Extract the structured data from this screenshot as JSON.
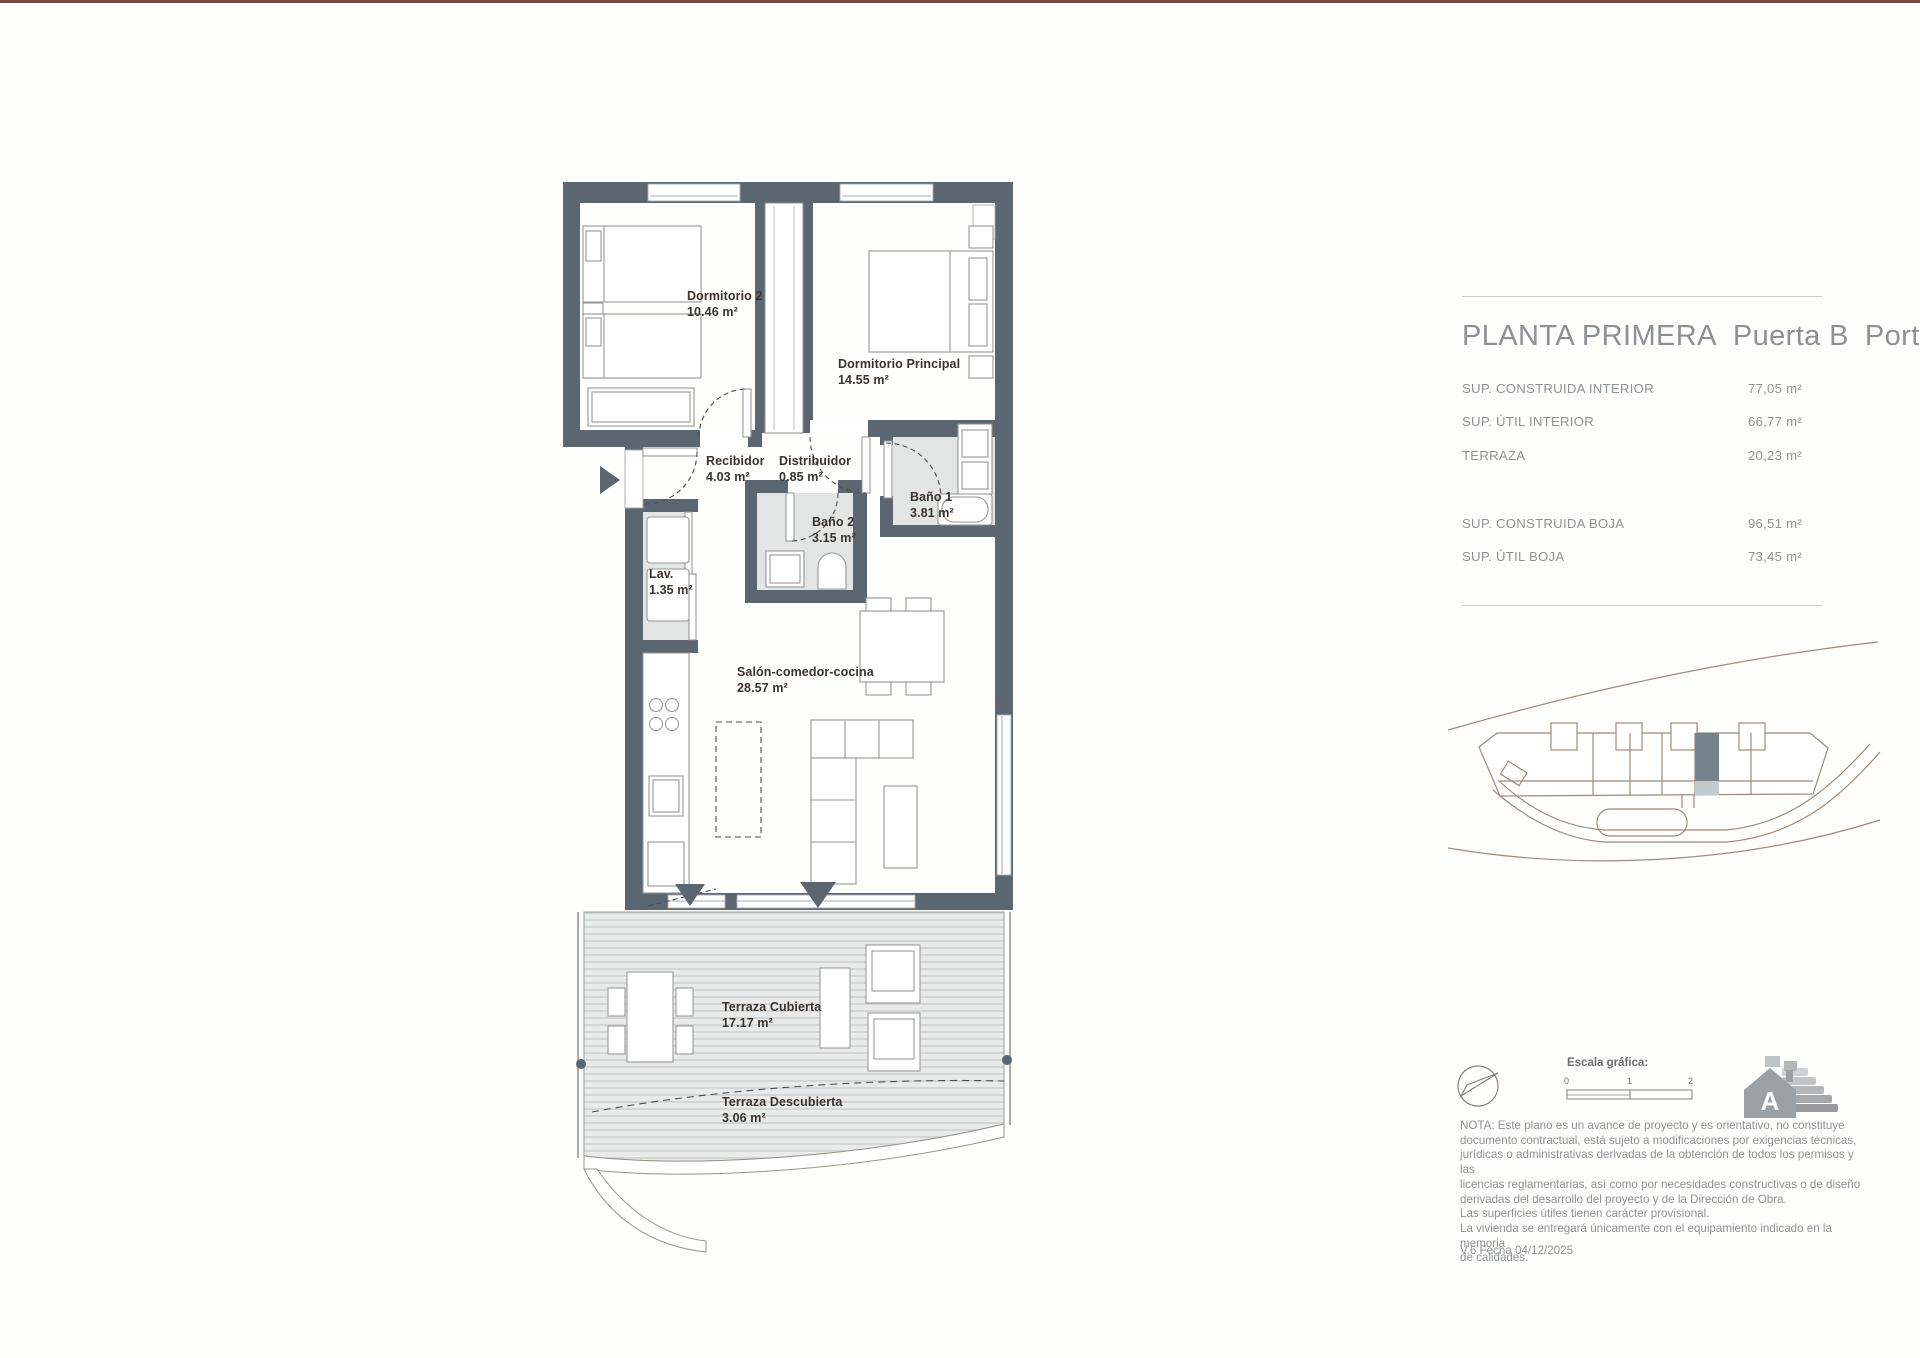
{
  "plan": {
    "rooms": [
      {
        "name": "Dormitorio 2",
        "area": "10.46 m²"
      },
      {
        "name": "Dormitorio Principal",
        "area": "14.55 m²"
      },
      {
        "name": "Recibidor",
        "area": "4.03 m²"
      },
      {
        "name": "Distribuidor",
        "area": "0.85 m²"
      },
      {
        "name": "Baño 1",
        "area": "3.81 m²"
      },
      {
        "name": "Baño 2",
        "area": "3.15 m²"
      },
      {
        "name": "Lav.",
        "area": "1.35 m²"
      },
      {
        "name": "Salón-comedor-cocina",
        "area": "28.57 m²"
      },
      {
        "name": "Terraza Cubierta",
        "area": "17.17 m²"
      },
      {
        "name": "Terraza Descubierta",
        "area": "3.06 m²"
      }
    ]
  },
  "info": {
    "title": {
      "part1": "PLANTA PRIMERA",
      "part2": "Puerta B",
      "part3": "Portal 3"
    },
    "surfaces": [
      {
        "label": "SUP. CONSTRUIDA INTERIOR",
        "value": "77,05 m²"
      },
      {
        "label": "SUP. ÚTIL INTERIOR",
        "value": "66,77 m²"
      },
      {
        "label": "TERRAZA",
        "value": "20,23 m²"
      },
      {
        "label": "SUP. CONSTRUIDA BOJA",
        "value": "96,51 m²"
      },
      {
        "label": "SUP. ÚTIL BOJA",
        "value": "73,45 m²"
      }
    ],
    "scale": {
      "label": "Escala gráfica:",
      "ticks": [
        "0",
        "1",
        "2"
      ]
    },
    "energy_rating": "A",
    "nota": "NOTA: Este plano es un avance de proyecto y es orientativo, no constituye\ndocumento contractual, está sujeto a modificaciones por exigencias técnicas,\njurídicas o administrativas derivadas de la obtención de todos los permisos y las\nlicencias reglamentarias, así como por necesidades constructivas o de diseño\nderivadas del desarrollo del proyecto y de la Dirección de Obra.\nLas superficies útiles tienen carácter provisional.\nLa vivienda se entregará únicamente con el equipamiento indicado en la memoria\nde calidades.",
    "version": "V.6 Fecha 04/12/2025"
  }
}
